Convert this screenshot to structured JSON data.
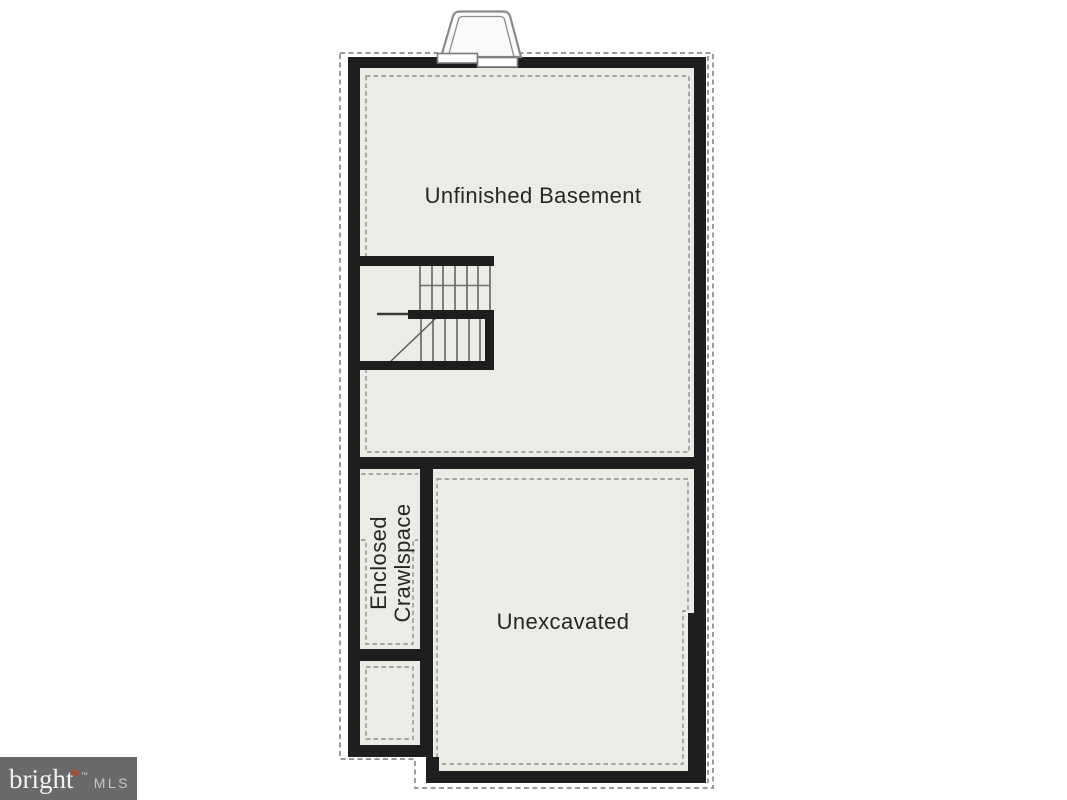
{
  "floorplan": {
    "rooms": {
      "basement": {
        "label": "Unfinished Basement"
      },
      "crawlspace": {
        "line1": "Enclosed",
        "line2": "Crawlspace"
      },
      "unexcavated": {
        "label": "Unexcavated"
      }
    },
    "colors": {
      "wall": "#1e1e1e",
      "floor": "#edebe6",
      "dashed_line": "#8b8b8b",
      "label_text": "#262626"
    }
  },
  "watermark": {
    "brand": "bright",
    "star": "✱",
    "trademark": "™",
    "suffix": "MLS",
    "colors": {
      "background": "#696969",
      "brand": "#f3f3f3",
      "star": "#b14a2c",
      "suffix": "#c6c6c6"
    }
  }
}
